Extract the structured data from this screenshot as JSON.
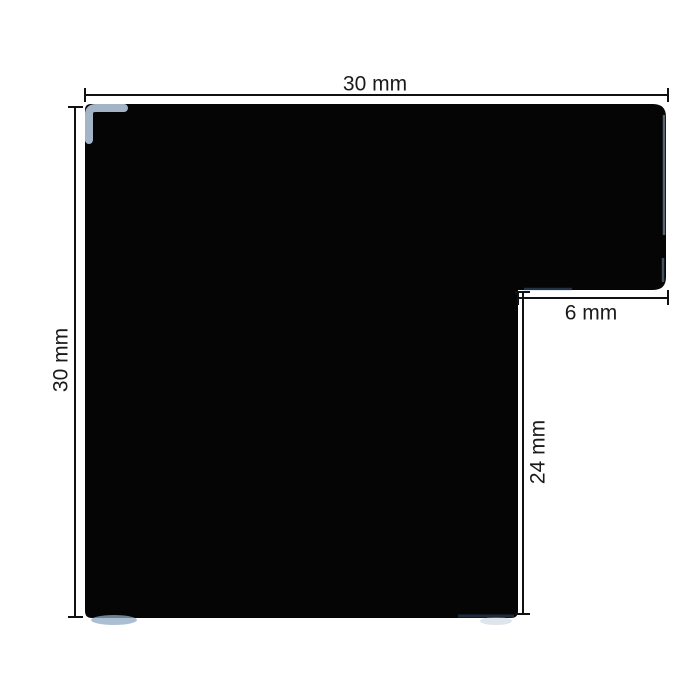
{
  "drawing": {
    "description": "Technical dimension drawing of a black L-shaped profile (square with rebate notch at bottom-right)",
    "background_color": "#ffffff",
    "shape": {
      "name": "l-profile-cross-section",
      "fill_color": "#050505",
      "highlight_color": "#b6c8dd",
      "edge_sheen_color": "#8fa9c4",
      "shadow_tint_color": "#22354f"
    },
    "dimension_line_color": "#111111",
    "label_color": "#1a1a1a",
    "dimensions": {
      "overall_width": {
        "label": "30 mm",
        "orientation": "horizontal",
        "position": "top"
      },
      "overall_height": {
        "label": "30 mm",
        "orientation": "vertical",
        "position": "left"
      },
      "rebate_width": {
        "label": "6 mm",
        "orientation": "horizontal",
        "position": "right-notch"
      },
      "rebate_depth": {
        "label": "24 mm",
        "orientation": "vertical",
        "position": "right-notch"
      }
    }
  }
}
